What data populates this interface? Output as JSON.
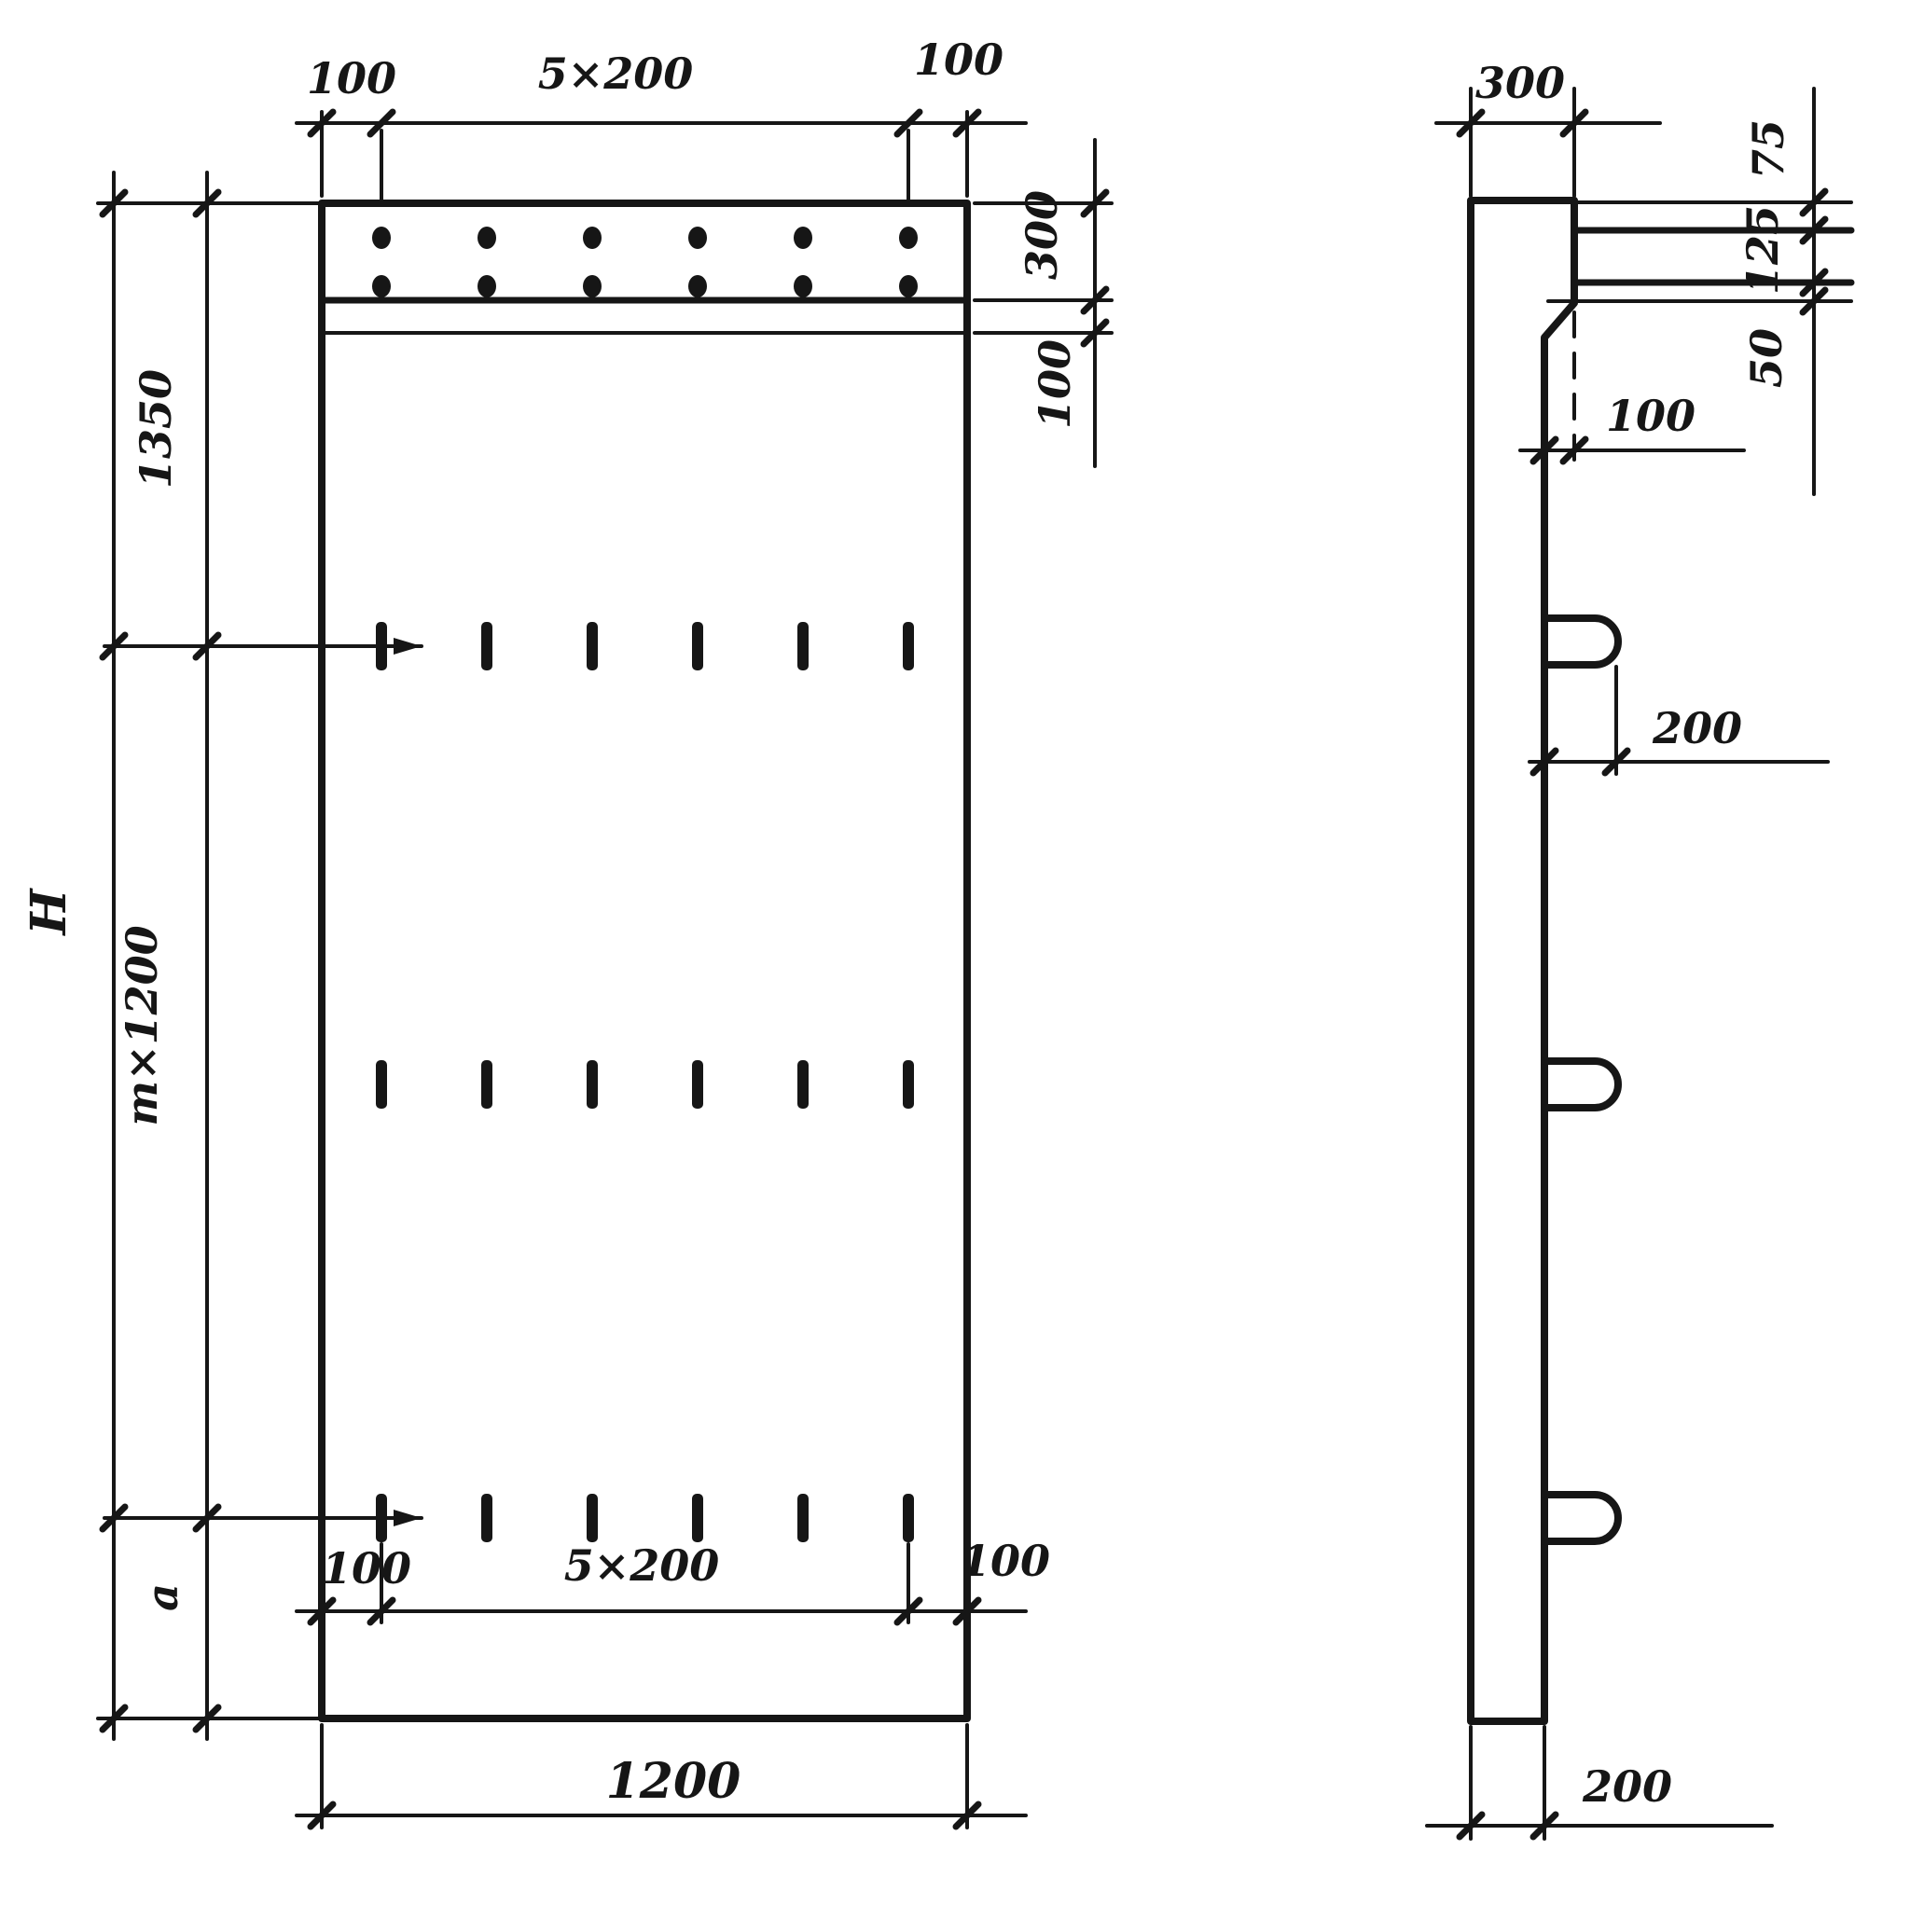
{
  "colors": {
    "paper": "#ffffff",
    "ink": "#161616"
  },
  "front_view": {
    "top_dim": {
      "left_margin": "100",
      "bolt_spacing": "5×200",
      "right_margin": "100"
    },
    "right_dim": {
      "cap_strip_height": "300",
      "cap_band_height": "100"
    },
    "left_dim": {
      "overall_height": "H",
      "top_segment": "1350",
      "middle_segment": "m×1200",
      "bottom_segment": "a"
    },
    "bottom_dim_inner": {
      "left_margin": "100",
      "tie_spacing": "5×200",
      "right_margin": "100"
    },
    "bottom_dim_overall": {
      "width": "1200"
    },
    "embed_dots": {
      "rows": 2,
      "columns": 6
    },
    "tie_marks": {
      "rows": 3,
      "columns": 6
    }
  },
  "side_view": {
    "top_dim": {
      "head_thickness": "300"
    },
    "right_dim": {
      "offset_top": "75",
      "offset_middle": "125",
      "offset_bottom": "50"
    },
    "chamfer_dim": {
      "offset": "100"
    },
    "loop_dim": {
      "protrusion": "200"
    },
    "bottom_dim": {
      "shaft_thickness": "200"
    },
    "loops": {
      "count": 3
    }
  }
}
